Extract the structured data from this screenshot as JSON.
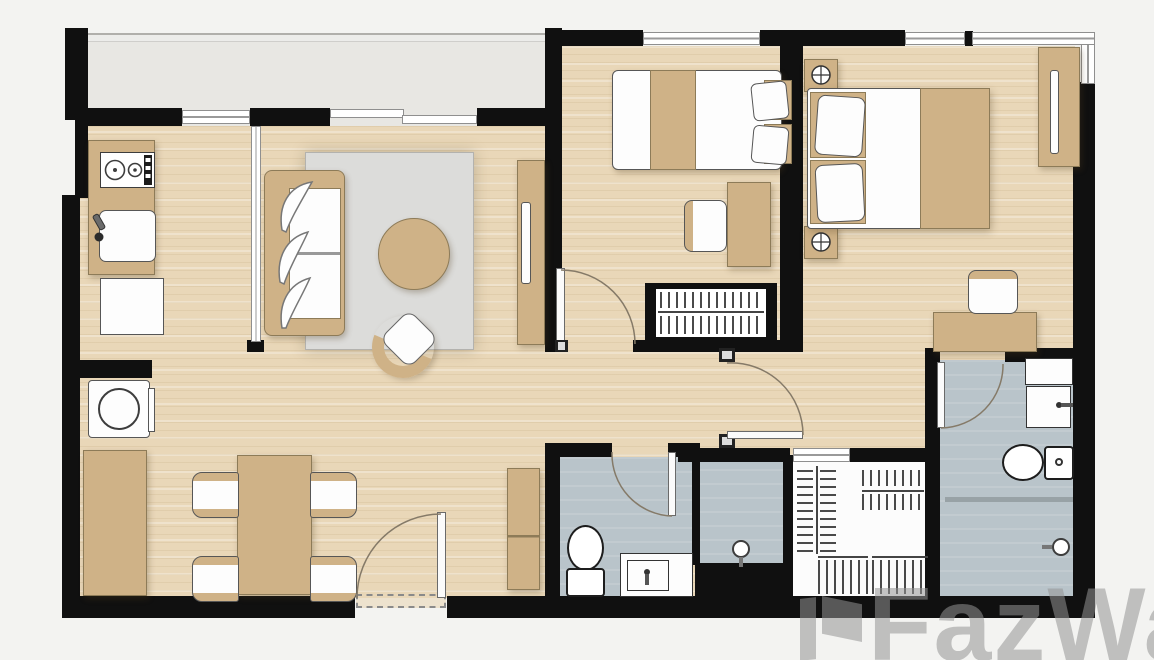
{
  "title": "Two-bedroom apartment floor plan",
  "watermark": {
    "text": "FazWaz"
  },
  "colors": {
    "background": "#f3f3f1",
    "wall": "#101010",
    "wood_floor": "#e9d7b8",
    "balcony_floor": "#e8e7e3",
    "bathroom_tile": "#b9c4ca",
    "rug": "#dcdcda",
    "furniture_tan": "#cfb287",
    "furniture_border": "#8d7b58",
    "closet_floor": "#fcfcfc",
    "watermark_gray": "rgba(148,148,148,0.55)"
  },
  "rooms": [
    {
      "name": "balcony",
      "furniture": []
    },
    {
      "name": "kitchen",
      "furniture": [
        "kitchen-counter",
        "stove",
        "kitchen-sink",
        "refrigerator"
      ]
    },
    {
      "name": "living-room",
      "furniture": [
        "sofa",
        "area-rug",
        "coffee-table",
        "lounge-chair",
        "tv-console",
        "tv"
      ]
    },
    {
      "name": "dining-area",
      "furniture": [
        "dining-table",
        "dining-chair",
        "dining-chair",
        "dining-chair",
        "dining-chair",
        "washing-machine",
        "sideboard-cabinet"
      ]
    },
    {
      "name": "entrance",
      "furniture": [
        "entrance-door",
        "shoe-cabinet"
      ]
    },
    {
      "name": "bedroom-2",
      "furniture": [
        "single-bed",
        "pillow",
        "desk",
        "desk-chair",
        "wardrobe",
        "clothes-rail"
      ]
    },
    {
      "name": "master-bedroom",
      "furniture": [
        "double-bed",
        "pillow",
        "pillow",
        "nightstand",
        "nightstand",
        "table-lamp",
        "table-lamp",
        "tv-console",
        "dressing-desk",
        "desk-chair"
      ]
    },
    {
      "name": "common-bathroom",
      "furniture": [
        "toilet",
        "wash-basin",
        "shower-head"
      ]
    },
    {
      "name": "shower-room",
      "furniture": [
        "shower-head"
      ]
    },
    {
      "name": "master-bathroom",
      "furniture": [
        "wash-basin",
        "toilet",
        "shower-head",
        "shelf"
      ]
    },
    {
      "name": "walk-in-closet",
      "furniture": [
        "clothes-rail",
        "clothes-rail",
        "clothes-rail",
        "clothes-rail"
      ]
    },
    {
      "name": "hallway",
      "furniture": []
    }
  ]
}
